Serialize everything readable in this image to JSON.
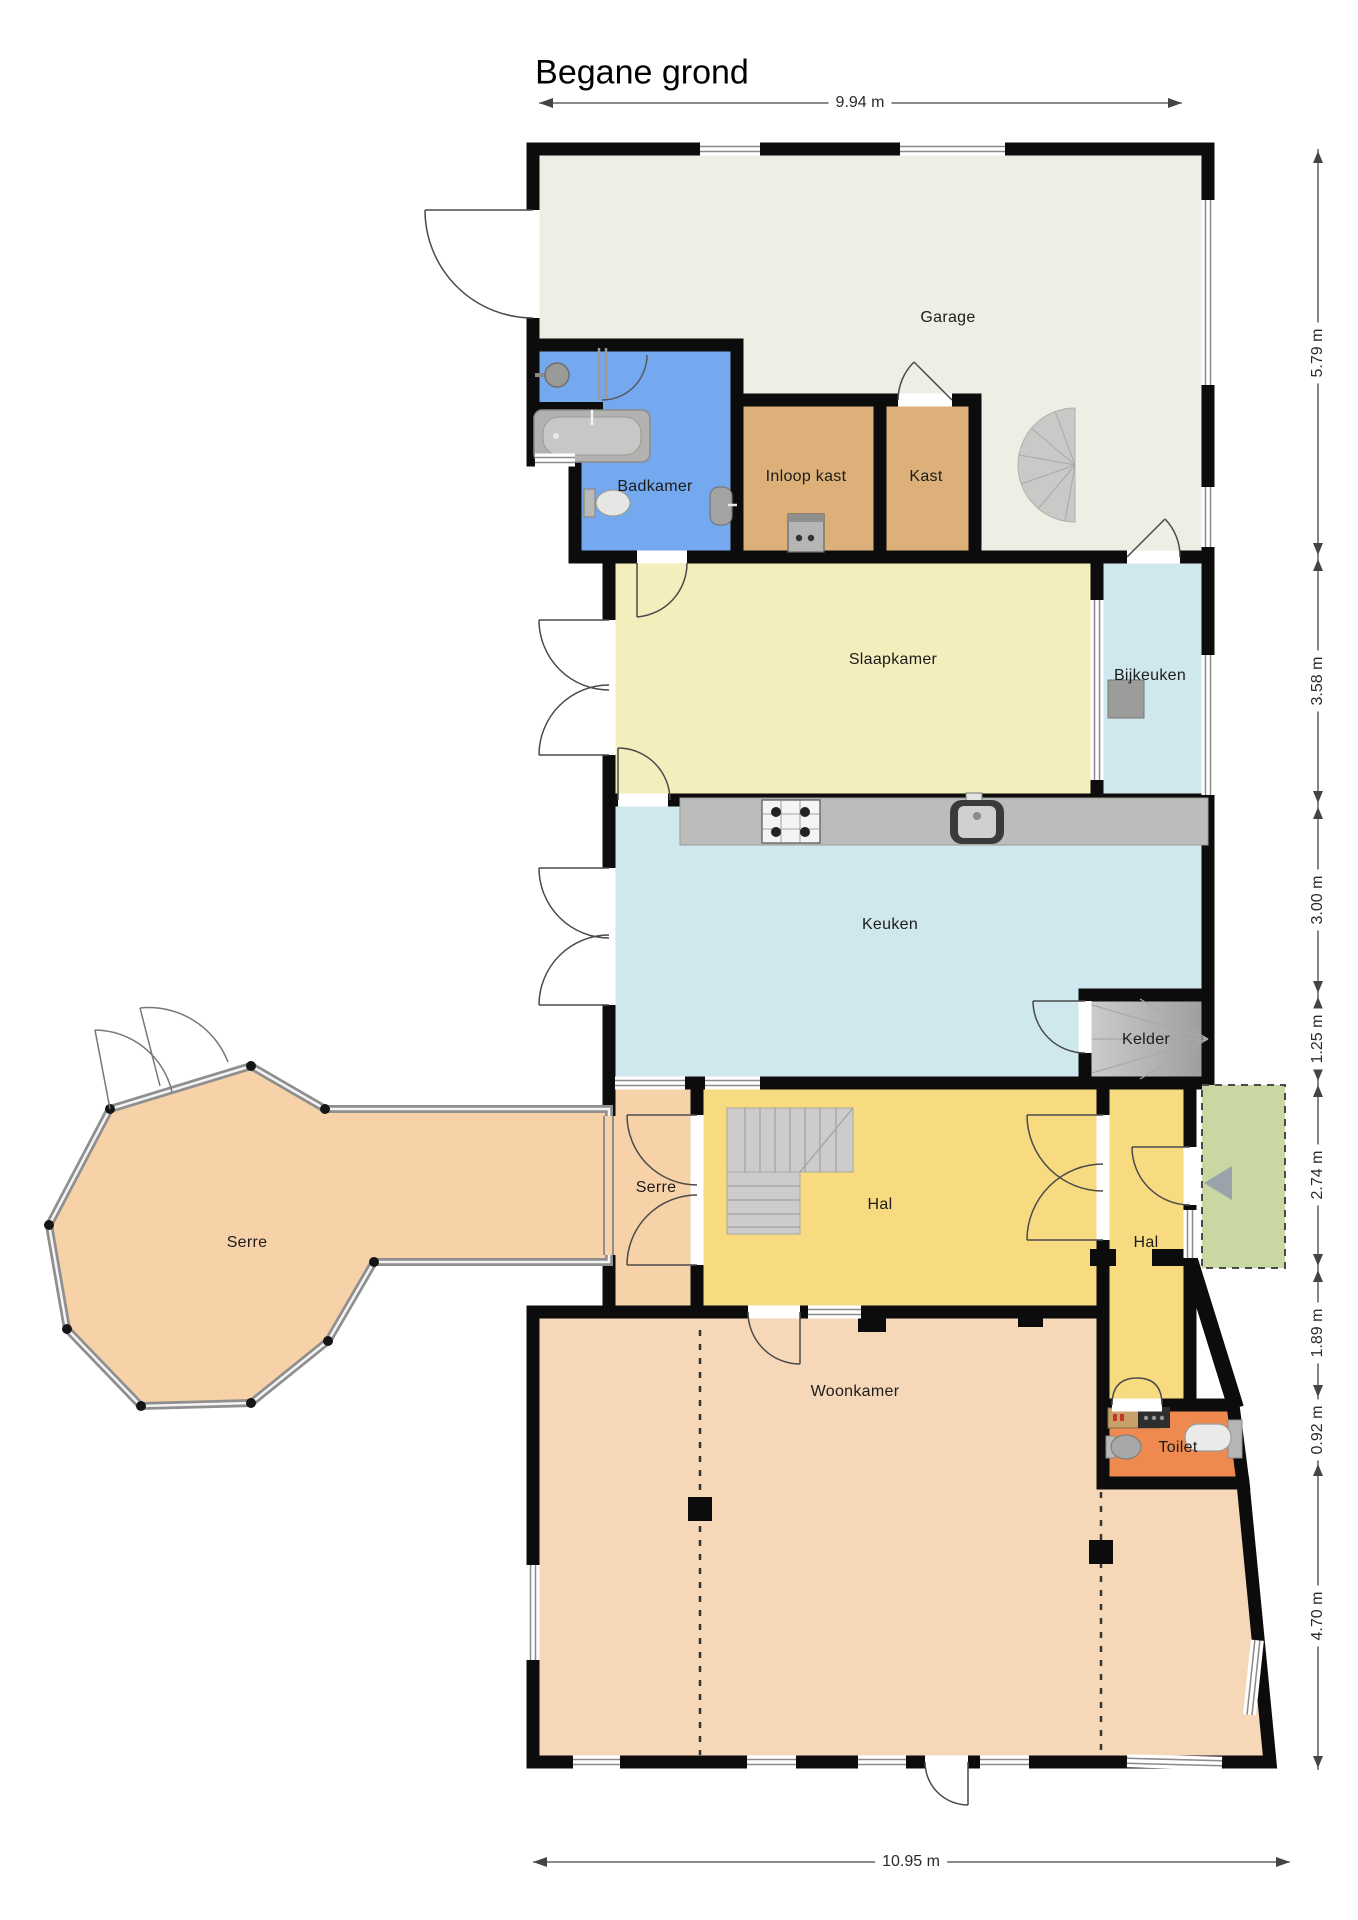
{
  "title": "Begane grond",
  "rooms": {
    "garage": {
      "label": "Garage",
      "color": "#eeeee4"
    },
    "badkamer": {
      "label": "Badkamer",
      "color": "#74a9ef"
    },
    "inloop_kast": {
      "label": "Inloop kast",
      "color": "#dcb078"
    },
    "kast": {
      "label": "Kast",
      "color": "#dcb078"
    },
    "slaapkamer": {
      "label": "Slaapkamer",
      "color": "#f4edbc"
    },
    "bijkeuken": {
      "label": "Bijkeuken",
      "color": "#cfe8ee"
    },
    "keuken": {
      "label": "Keuken",
      "color": "#cfe8ee"
    },
    "kelder": {
      "label": "Kelder",
      "color": "#b9b9b7"
    },
    "serre_large": {
      "label": "Serre",
      "color": "#f7d2a8"
    },
    "serre_small": {
      "label": "Serre",
      "color": "#f7d2a8"
    },
    "hal_main": {
      "label": "Hal",
      "color": "#f8da80"
    },
    "hal_side": {
      "label": "Hal",
      "color": "#f8da80"
    },
    "toilet": {
      "label": "Toilet",
      "color": "#ee8a4f"
    },
    "woonkamer": {
      "label": "Woonkamer",
      "color": "#f6d8b8"
    }
  },
  "dimensions": {
    "top": "9.94 m",
    "bottom": "10.95 m",
    "right": [
      "5.79 m",
      "3.58 m",
      "3.00 m",
      "1.25 m",
      "2.74 m",
      "1.89 m",
      "0.92 m",
      "4.70 m"
    ]
  },
  "colors": {
    "wall": "#0c0c0c",
    "counter": "#bcbcba",
    "stairs": "#ccccca",
    "porch": "#c9d7a3",
    "fixture": "#b5b5b3"
  }
}
